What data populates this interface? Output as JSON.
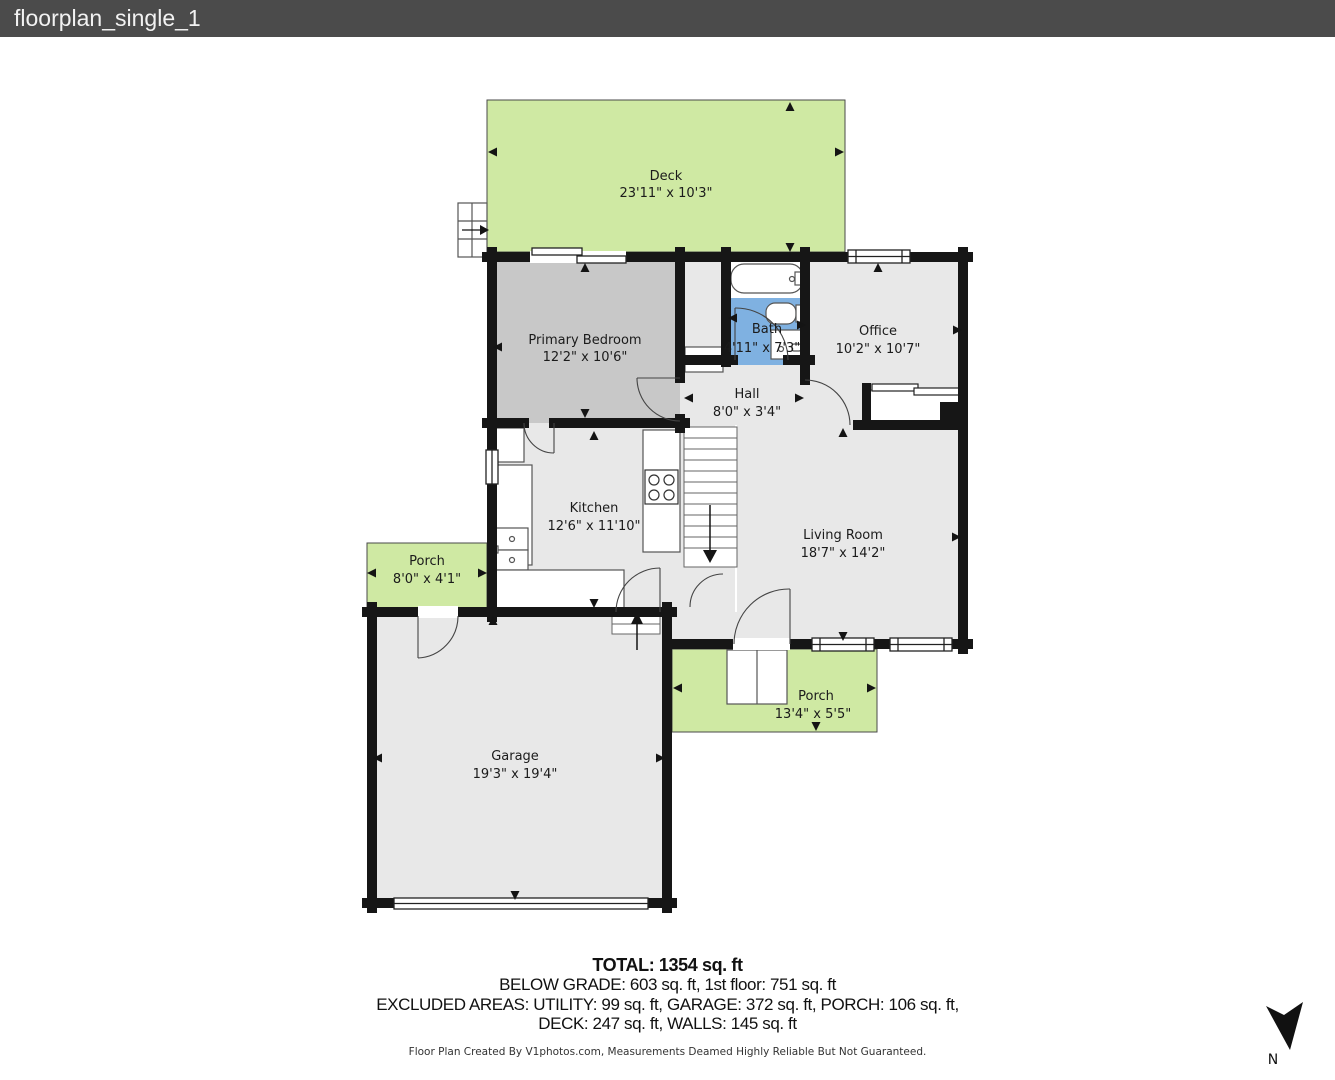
{
  "title_bar": {
    "filename": "floorplan_single_1"
  },
  "rooms": {
    "deck": {
      "name": "Deck",
      "dims": "23'11\" x 10'3\""
    },
    "primary_bedroom": {
      "name": "Primary Bedroom",
      "dims": "12'2\" x 10'6\""
    },
    "bath": {
      "name": "Bath",
      "dims": "4'11\" x 7'3\""
    },
    "office": {
      "name": "Office",
      "dims": "10'2\" x 10'7\""
    },
    "hall": {
      "name": "Hall",
      "dims": "8'0\" x 3'4\""
    },
    "kitchen": {
      "name": "Kitchen",
      "dims": "12'6\" x 11'10\""
    },
    "living_room": {
      "name": "Living Room",
      "dims": "18'7\" x 14'2\""
    },
    "porch_side": {
      "name": "Porch",
      "dims": "8'0\" x 4'1\""
    },
    "porch_front": {
      "name": "Porch",
      "dims": "13'4\" x 5'5\""
    },
    "garage": {
      "name": "Garage",
      "dims": "19'3\" x 19'4\""
    }
  },
  "summary": {
    "total": "TOTAL: 1354 sq. ft",
    "line1": "BELOW GRADE: 603 sq. ft, 1st floor: 751 sq. ft",
    "line2": "EXCLUDED AREAS: UTILITY: 99 sq. ft, GARAGE: 372 sq. ft, PORCH: 106 sq. ft,",
    "line3": "DECK: 247 sq. ft, WALLS: 145 sq. ft"
  },
  "footer": {
    "credit": "Floor Plan Created By V1photos.com, Measurements Deamed Highly Reliable But Not Guaranteed."
  },
  "compass": {
    "label": "N"
  },
  "colors": {
    "topbar": "#4b4b4b",
    "wall": "#161616",
    "deck_porch_fill": "#cfe9a3",
    "bedroom_fill": "#c8c8c8",
    "room_fill": "#e8e8e8",
    "bath_fill": "#7fb1e1"
  }
}
